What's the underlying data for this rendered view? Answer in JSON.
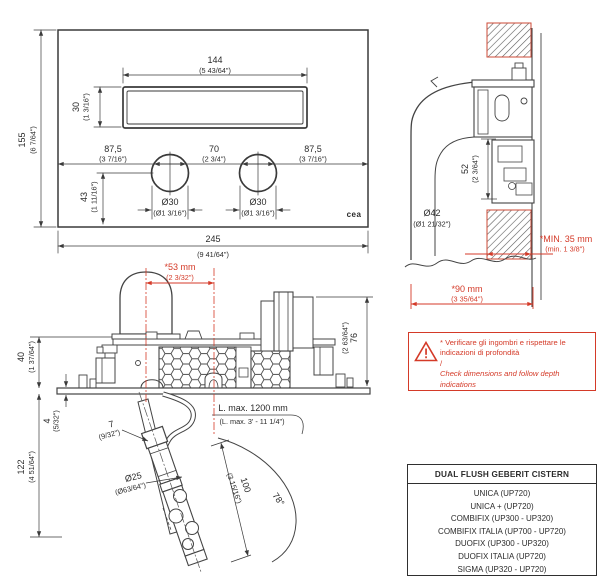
{
  "brand": {
    "logo_text": "cea"
  },
  "front_view": {
    "slot_width_mm": "144",
    "slot_width_in": "(5 43/64\")",
    "slot_height_mm": "30",
    "slot_height_in": "(1 3/16\")",
    "plate_height_mm": "155",
    "plate_height_in": "(6 7/64\")",
    "left_span_mm": "87,5",
    "left_span_in": "(3 7/16\")",
    "center_span_mm": "70",
    "center_span_in": "(2 3/4\")",
    "right_span_mm": "87,5",
    "right_span_in": "(3 7/16\")",
    "button_offset_mm": "43",
    "button_offset_in": "(1 11/16\")",
    "button_dia_mm": "Ø30",
    "button_dia_in": "(Ø1 3/16\")",
    "plate_width_mm": "245",
    "plate_width_in": "(9 41/64\")"
  },
  "side_view": {
    "recess_mm": "52",
    "recess_in": "(2 3/64\")",
    "pipe_dia_mm": "Ø42",
    "pipe_dia_in": "(Ø1 21/32\")",
    "min_depth_mm": "*MIN. 35 mm",
    "min_depth_in": "(min. 1 3/8\")",
    "depth_mm": "*90 mm",
    "depth_in": "(3 35/64\")"
  },
  "mechanism_view": {
    "offset_mm": "*53 mm",
    "offset_in": "(2 3/32\")",
    "body_height_mm": "76",
    "body_height_in": "(2 63/64\")",
    "frame_height_mm": "40",
    "frame_height_in": "(1 37/64\")",
    "plate_thickness_mm": "4",
    "plate_thickness_in": "(5/32\")",
    "drop_mm": "122",
    "drop_in": "(4 51/64\")",
    "gap_mm": "7",
    "gap_in": "(9/32\")",
    "hose_length_line1": "L. max. 1200 mm",
    "hose_length_line2": "(L. max. 3' - 11 1/4\")",
    "tube_dia_mm": "Ø25",
    "tube_dia_in": "(Ø63/64\")",
    "tube_len_mm": "100",
    "tube_len_in": "(3 15/16\")",
    "swing_angle": "78°"
  },
  "warning": {
    "line1": "* Verificare gli ingombri e rispettare le",
    "line2": "indicazioni di profondità",
    "line3": "/",
    "line4": "Check dimensions and follow depth",
    "line5": "indications"
  },
  "table": {
    "header": "DUAL FLUSH GEBERIT CISTERN",
    "models": [
      "UNICA (UP720)",
      "UNICA + (UP720)",
      "COMBIFIX (UP300 - UP320)",
      "COMBIFIX ITALIA (UP700 - UP720)",
      "DUOFIX (UP300 - UP320)",
      "DUOFIX ITALIA (UP720)",
      "SIGMA (UP320 - UP720)"
    ]
  },
  "colors": {
    "line": "#3a3a3a",
    "red": "#d43a28"
  }
}
